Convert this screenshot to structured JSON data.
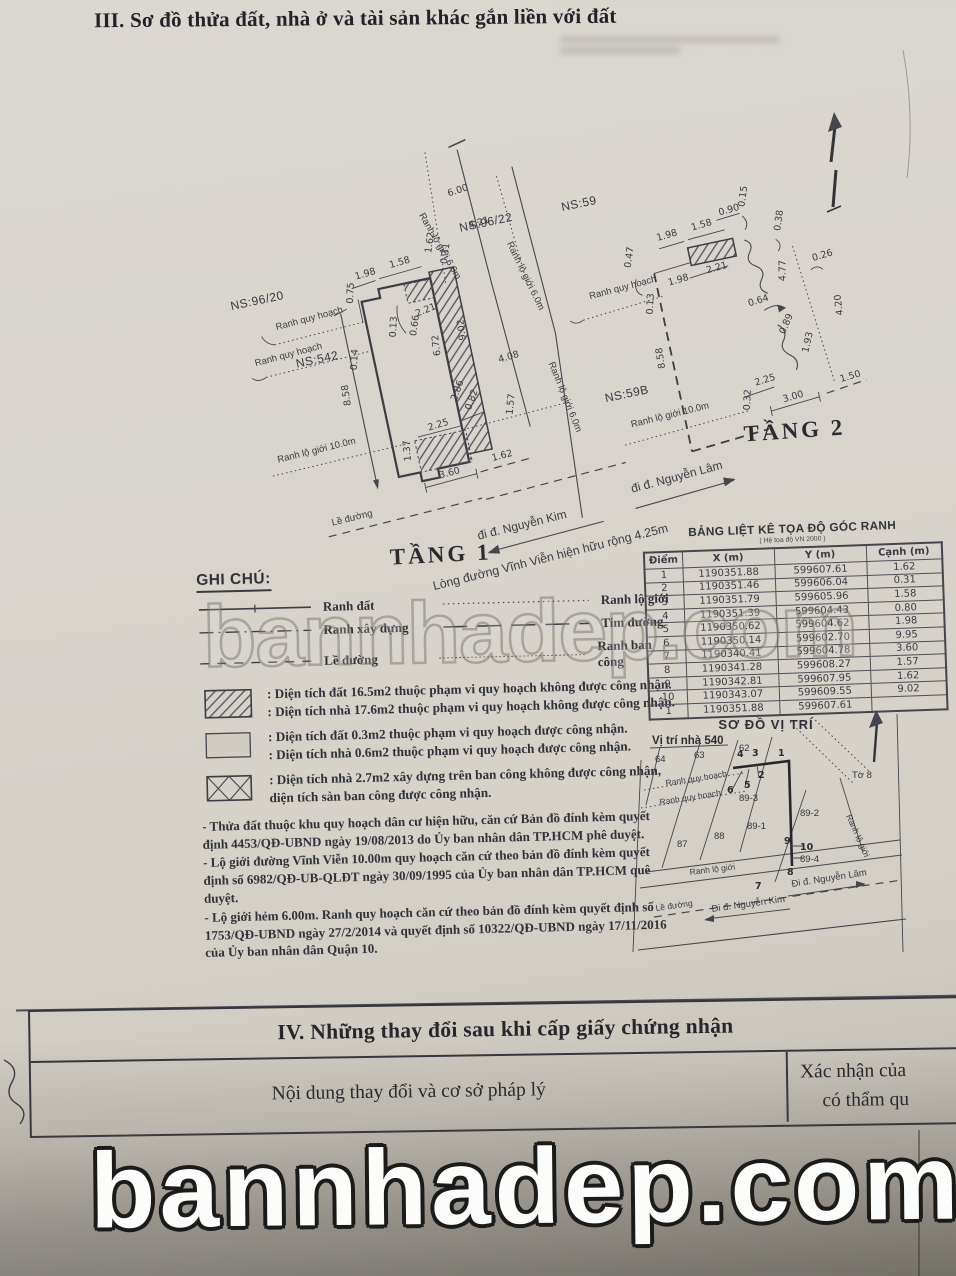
{
  "page": {
    "title": "III. Sơ đồ thửa đất, nhà ở và tài sản khác gắn liền với đất"
  },
  "tang1": {
    "name": "TẦNG 1",
    "ns_96_22": "NS:96/22",
    "ns_96_20": "NS:96/20",
    "ns_542": "NS:542",
    "ranh_quy_hoach": "Ranh quy hoạch",
    "ranh_lo_gioi_6": "Ranh lộ giới 6.0m",
    "ranh_lo_gioi_10": "Ranh lộ giới 10.0m",
    "le_duong": "Lề đường",
    "street_left": "đi đ. Nguyễn Kim",
    "street_right": "đi đ. Nguyễn Lâm",
    "street_note": "Lòng đường Vĩnh Viễn hiện hữu rộng 4.25m",
    "dims": [
      "6.00",
      "4.21",
      "1.62",
      "0.31",
      "1.98",
      "1.58",
      "0.75",
      "2.21",
      "0.13",
      "0.66",
      "0.14",
      "6.72",
      "9.02",
      "8.58",
      "4.08",
      "2.86",
      "0.82",
      "1.57",
      "2.25",
      "1.37",
      "3.60",
      "1.62"
    ]
  },
  "tang2": {
    "name": "TẦNG 2",
    "ns_59": "NS:59",
    "ns_59b": "NS:59B",
    "ranh_quy_hoach": "Ranh quy hoạch",
    "ranh_lo_gioi_6": "Ranh lộ giới 6.0m",
    "ranh_lo_gioi_10": "Ranh lộ giới 10.0m",
    "dims": [
      "1.98",
      "1.58",
      "0.90",
      "0.15",
      "0.38",
      "0.47",
      "1.98",
      "2.21",
      "4.77",
      "0.13",
      "0.26",
      "0.64",
      "8.58",
      "0.89",
      "1.93",
      "4.20",
      "2.25",
      "0.32",
      "3.00",
      "1.50"
    ]
  },
  "legend": {
    "heading": "GHI CHÚ:",
    "lines": [
      "Ranh đất",
      "Ranh xây dựng",
      "Lề đường",
      "Ranh lộ giới",
      "Tim đường",
      "Ranh ban công"
    ],
    "areas": [
      {
        "l1": ": Diện tích đất 16.5m2 thuộc phạm vi quy hoạch không được công nhận.",
        "l2": ": Diện tích nhà 17.6m2 thuộc phạm vi quy hoạch không được công nhận."
      },
      {
        "l1": ": Diện tích đất 0.3m2 thuộc phạm vi quy hoạch được công nhận.",
        "l2": ": Diện tích nhà 0.6m2 thuộc phạm vi quy hoạch được công nhận."
      },
      {
        "l1": ": Diện tích nhà 2.7m2 xây dựng trên ban công không được công nhận,",
        "l2": "diện tích sàn ban công được công nhận."
      }
    ],
    "notes": [
      "- Thửa đất thuộc khu quy hoạch dân cư hiện hữu, căn cứ Bản đồ đính kèm quyết định 4453/QĐ-UBND ngày 19/08/2013 do Ủy ban nhân dân TP.HCM phê duyệt.",
      "- Lộ giới đường Vĩnh Viễn 10.00m quy hoạch căn cứ theo bản đồ đính kèm quyết định số 6982/QĐ-UB-QLĐT ngày 30/09/1995 của Ủy ban nhân dân TP.HCM quê duyệt.",
      "- Lộ giới hẻm 6.00m. Ranh quy hoạch căn cứ theo bản đồ đính kèm quyết định số 1753/QĐ-UBND ngày 27/2/2014 và quyết định số 10322/QĐ-UBND ngày 17/11/2016 của Ủy ban nhân dân Quận 10."
    ]
  },
  "coord_table": {
    "title": "BẢNG LIỆT KÊ TỌA ĐỘ GÓC RANH",
    "subtitle": "( Hệ tọa độ VN 2000 )",
    "headers": [
      "Điểm",
      "X (m)",
      "Y (m)",
      "Cạnh (m)"
    ],
    "rows": [
      [
        "1",
        "1190351.88",
        "599607.61",
        "1.62"
      ],
      [
        "2",
        "1190351.46",
        "599606.04",
        "0.31"
      ],
      [
        "3",
        "1190351.79",
        "599605.96",
        "1.58"
      ],
      [
        "4",
        "1190351.39",
        "599604.43",
        "0.80"
      ],
      [
        "5",
        "1190350.62",
        "599604.62",
        "1.98"
      ],
      [
        "6",
        "1190350.14",
        "599602.70",
        "9.95"
      ],
      [
        "7",
        "1190340.41",
        "599604.78",
        "3.60"
      ],
      [
        "8",
        "1190341.28",
        "599608.27",
        "1.57"
      ],
      [
        "9",
        "1190342.81",
        "599607.95",
        "1.62"
      ],
      [
        "10",
        "1190343.07",
        "599609.55",
        "9.02"
      ],
      [
        "1",
        "1190351.88",
        "599607.61",
        ""
      ]
    ]
  },
  "site_map": {
    "title": "SƠ ĐỒ VỊ TRÍ",
    "subtitle": "Vị trí nhà 540",
    "parcels": [
      "64",
      "63",
      "62",
      "87",
      "88",
      "89-1",
      "89-2",
      "89-3",
      "89-4"
    ],
    "points": [
      "1",
      "2",
      "3",
      "4",
      "5",
      "6",
      "7",
      "8",
      "9",
      "10"
    ],
    "to8": "Tờ 8",
    "ranh_quy_hoach": "Ranh quy hoạch",
    "ranh_lo_gioi": "Ranh lộ giới",
    "le_duong": "Lề đường",
    "street_kim": "Đi đ. Nguyễn Kim",
    "street_lam": "Đi đ. Nguyễn Lâm"
  },
  "section4": {
    "title": "IV. Những thay đổi sau khi cấp giấy chứng nhận",
    "col_content": "Nội dung thay đổi và cơ sở pháp lý",
    "col_confirm_1": "Xác nhận của",
    "col_confirm_2": "có thẩm qu"
  },
  "watermark": {
    "text": "bannhadep.com"
  }
}
